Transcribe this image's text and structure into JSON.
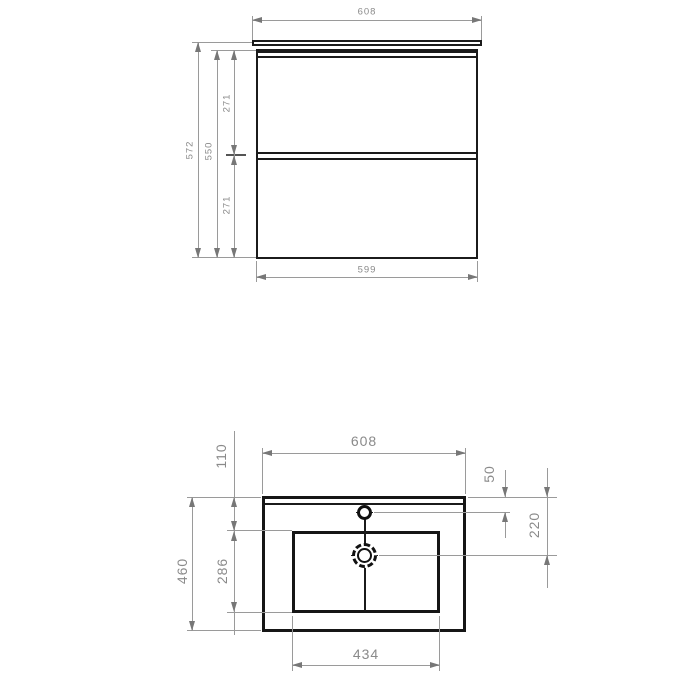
{
  "drawing": {
    "title": "vanity-unit-technical-drawing",
    "colors": {
      "background": "#ffffff",
      "object_line": "#1b1b1b",
      "dimension_line": "#9a9a9a",
      "dimension_text": "#8a8a8a"
    },
    "cabinet_front_view": {
      "width_top": "608",
      "height_overall": "572",
      "height_front": "550",
      "drawer_upper_height": "271",
      "drawer_lower_height": "271",
      "width_body": "599"
    },
    "basin_top_view": {
      "width": "608",
      "rim_to_basin": "110",
      "tap_hole_offset": "50",
      "drain_offset": "220",
      "depth_overall": "460",
      "basin_depth": "286",
      "basin_width": "434"
    }
  }
}
